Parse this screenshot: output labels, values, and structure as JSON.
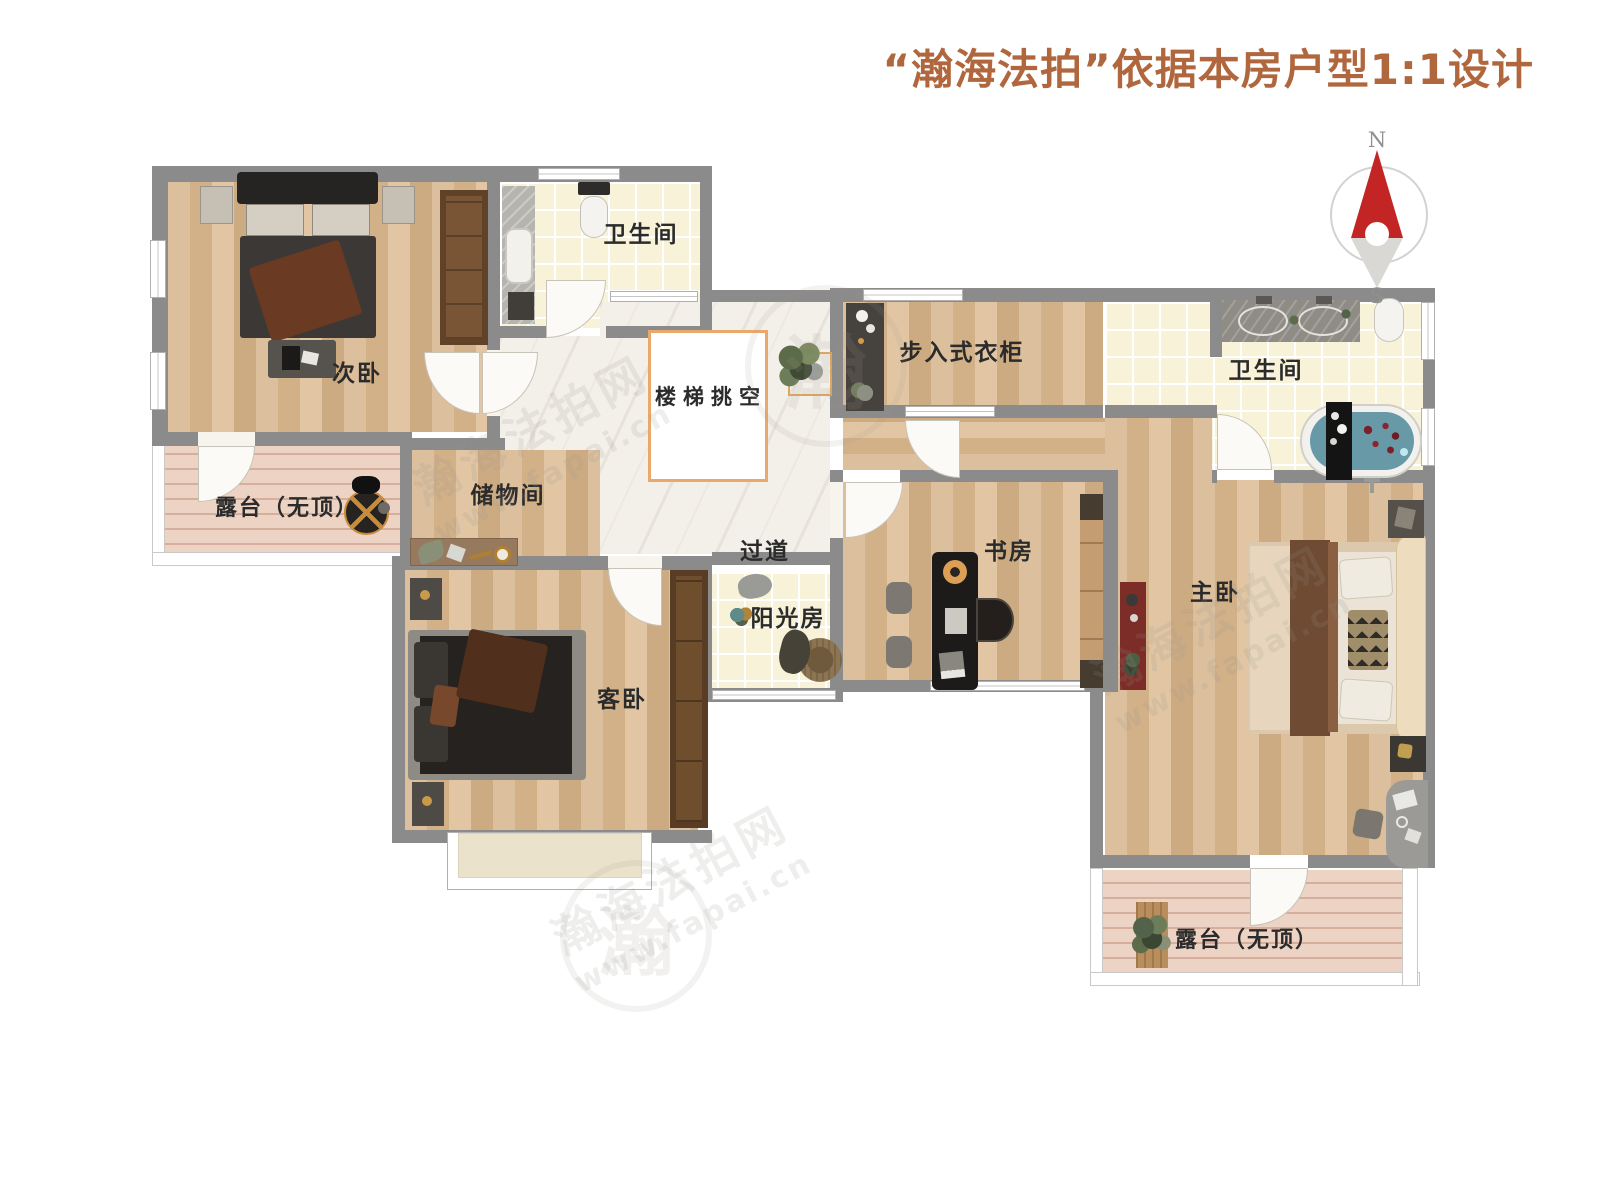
{
  "title": {
    "text": "“瀚海法拍”依据本房户型1:1设计"
  },
  "compass": {
    "north": "N",
    "south": "S"
  },
  "rooms": {
    "secondary_bedroom": {
      "label": "次卧"
    },
    "bathroom_top": {
      "label": "卫生间"
    },
    "stair_void": {
      "label": "楼梯挑空"
    },
    "hallway": {
      "label": "过道"
    },
    "walk_in_closet": {
      "label": "步入式衣柜"
    },
    "bathroom_master": {
      "label": "卫生间"
    },
    "terrace_left": {
      "label": "露台（无顶）"
    },
    "storage_room": {
      "label": "储物间"
    },
    "guest_bedroom": {
      "label": "客卧"
    },
    "sunroom": {
      "label": "阳光房"
    },
    "study": {
      "label": "书房"
    },
    "master_bedroom": {
      "label": "主卧"
    },
    "terrace_bottom": {
      "label": "露台（无顶）"
    }
  },
  "watermarks": {
    "brand": "瀚海法拍网",
    "url": "www.fapai.cn",
    "emblem_char": "瀚"
  },
  "colors": {
    "title_accent": "#b1673e",
    "wall": "#8b8b8b",
    "stair_void_border": "#e9a96b",
    "compass_needle": "#c32424",
    "wood_floor": "#d8b893",
    "tile_floor": "#f8f3d8",
    "deck_floor": "#edd3c3"
  }
}
